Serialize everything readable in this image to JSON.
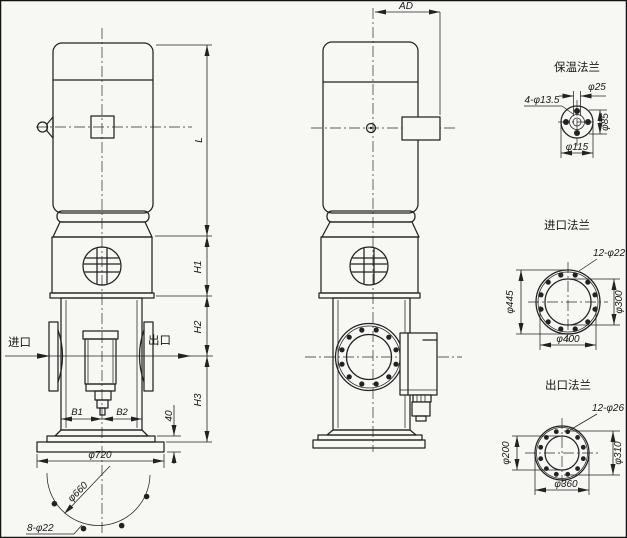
{
  "colors": {
    "line": "#222222",
    "paper": "#f7f7f4"
  },
  "side_view": {
    "dim_ad": "AD"
  },
  "front_view": {
    "inlet_label": "进口",
    "outlet_label": "出口",
    "dim_l": "L",
    "dim_h1": "H1",
    "dim_h2": "H2",
    "dim_h3": "H3",
    "dim_b1": "B1",
    "dim_b2": "B2",
    "dim_base_height": "40",
    "dim_base_od": "φ720",
    "dim_base_bolt_circle": "φ660",
    "dim_anchor_holes": "8-φ22"
  },
  "flanges": {
    "insulation": {
      "title": "保温法兰",
      "holes": "4-φ13.5",
      "hole_count": 4,
      "bore": "φ25",
      "pitch": "φ85",
      "od": "φ115"
    },
    "inlet": {
      "title": "进口法兰",
      "holes": "12-φ22",
      "hole_count": 12,
      "od": "φ445",
      "bore": "φ300",
      "pitch": "φ400"
    },
    "outlet": {
      "title": "出口法兰",
      "holes": "12-φ26",
      "hole_count": 12,
      "bore": "φ200",
      "pitch": "φ310",
      "od": "φ360"
    }
  }
}
